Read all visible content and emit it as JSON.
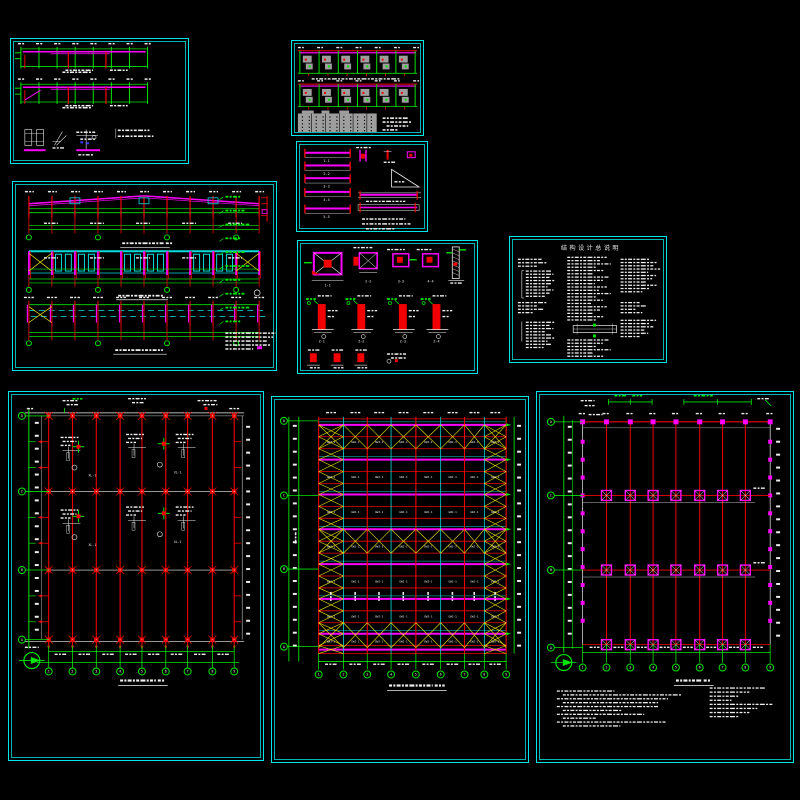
{
  "window": {
    "width": 800,
    "height": 800,
    "background": "#000000"
  },
  "palette": {
    "frame": "#00e6e6",
    "frame_inner": "#00b4b4",
    "red": "#f20000",
    "green": "#00e600",
    "magenta": "#ff00ff",
    "yellow": "#f2e600",
    "white": "#efefef",
    "gray": "#9e9e9e",
    "cyan": "#00dcdc",
    "blue": "#3a3aff"
  },
  "sheets": [
    {
      "id": "s1",
      "name": "girt-elevation-sheet",
      "x": 10,
      "y": 38,
      "w": 179,
      "h": 126
    },
    {
      "id": "s2",
      "name": "frame-elevation-sheet",
      "x": 291,
      "y": 40,
      "w": 133,
      "h": 96
    },
    {
      "id": "s3",
      "name": "truss-elevation-sheet",
      "x": 12,
      "y": 181,
      "w": 265,
      "h": 190
    },
    {
      "id": "s4",
      "name": "beam-detail-sheet",
      "x": 296,
      "y": 141,
      "w": 132,
      "h": 91
    },
    {
      "id": "s5",
      "name": "column-detail-sheet",
      "x": 297,
      "y": 240,
      "w": 181,
      "h": 134
    },
    {
      "id": "s6",
      "name": "general-notes-sheet",
      "x": 509,
      "y": 236,
      "w": 158,
      "h": 127
    },
    {
      "id": "s7",
      "name": "column-layout-plan-sheet",
      "x": 8,
      "y": 391,
      "w": 256,
      "h": 370
    },
    {
      "id": "s8",
      "name": "roof-bracing-plan-sheet",
      "x": 271,
      "y": 396,
      "w": 258,
      "h": 367
    },
    {
      "id": "s9",
      "name": "foundation-plan-sheet",
      "x": 536,
      "y": 391,
      "w": 258,
      "h": 372
    }
  ],
  "notes_sheet": {
    "title": "结构设计总说明"
  },
  "bracing_plan": {
    "cell_label": "GWJ-1",
    "bays": 8,
    "axis_numbers": [
      "1",
      "2",
      "3",
      "4",
      "5",
      "6",
      "7",
      "8",
      "9"
    ],
    "axis_letters": [
      "A",
      "B",
      "C",
      "D"
    ]
  },
  "column_plan": {
    "detail_label": "XL-1",
    "axis_numbers": [
      "1",
      "2",
      "3",
      "4",
      "5",
      "6",
      "7",
      "8",
      "9"
    ],
    "axis_letters": [
      "A",
      "B",
      "C",
      "D"
    ]
  },
  "foundation_plan": {
    "marker_label": "J-1",
    "axis_numbers": [
      "1",
      "2",
      "3",
      "4",
      "5",
      "6",
      "7",
      "8",
      "9"
    ],
    "axis_letters": [
      "A",
      "B",
      "C",
      "D"
    ]
  },
  "details": {
    "beam_labels": [
      "1-1",
      "2-2",
      "3-3",
      "4-4",
      "5-5"
    ],
    "column_labels": [
      "Z-1",
      "Z-2",
      "Z-3",
      "Z-4"
    ]
  }
}
